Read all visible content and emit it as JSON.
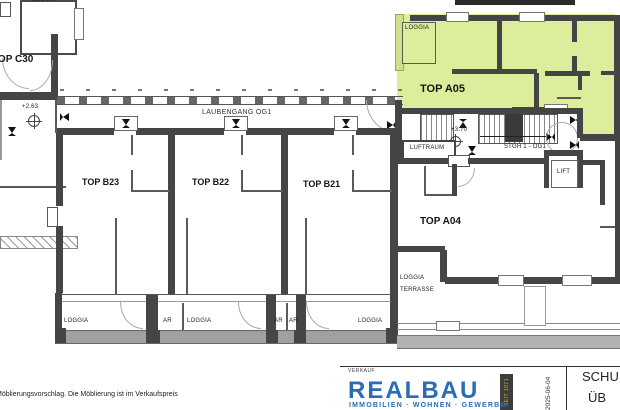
{
  "plan": {
    "highlight_color": "#dcee9b",
    "corridor_label": "LAUBENGANG OG1",
    "units": {
      "c30": "TOP C30",
      "b23": "TOP B23",
      "b22": "TOP B22",
      "b21": "TOP B21",
      "a05": "TOP A05",
      "a04": "TOP A04"
    },
    "rooms": {
      "loggia": "LOGGIA",
      "ar": "AR",
      "terrasse": "TERRASSE",
      "luftraum": "LUFTRAUM",
      "stairs": "STGH 1 - OG1",
      "lift": "LIFT"
    },
    "levels": {
      "c30_level": "+2.63",
      "stair_level": "+3.70"
    }
  },
  "footer": {
    "disclaimer": "Möblierungsvorschlag. Die Möblierung ist im Verkaufspreis",
    "verkauf": "VERKAUF",
    "brand_name": "REALBAU",
    "brand_badge": "SEIT 1971",
    "brand_tagline": "IMMOBILIEN · WOHNEN · GEWERBE",
    "brand_color": "#2b6cb5",
    "date": "2025-06-04",
    "sheet_title_line1": "SCHU",
    "sheet_title_line2": "ÜB"
  }
}
